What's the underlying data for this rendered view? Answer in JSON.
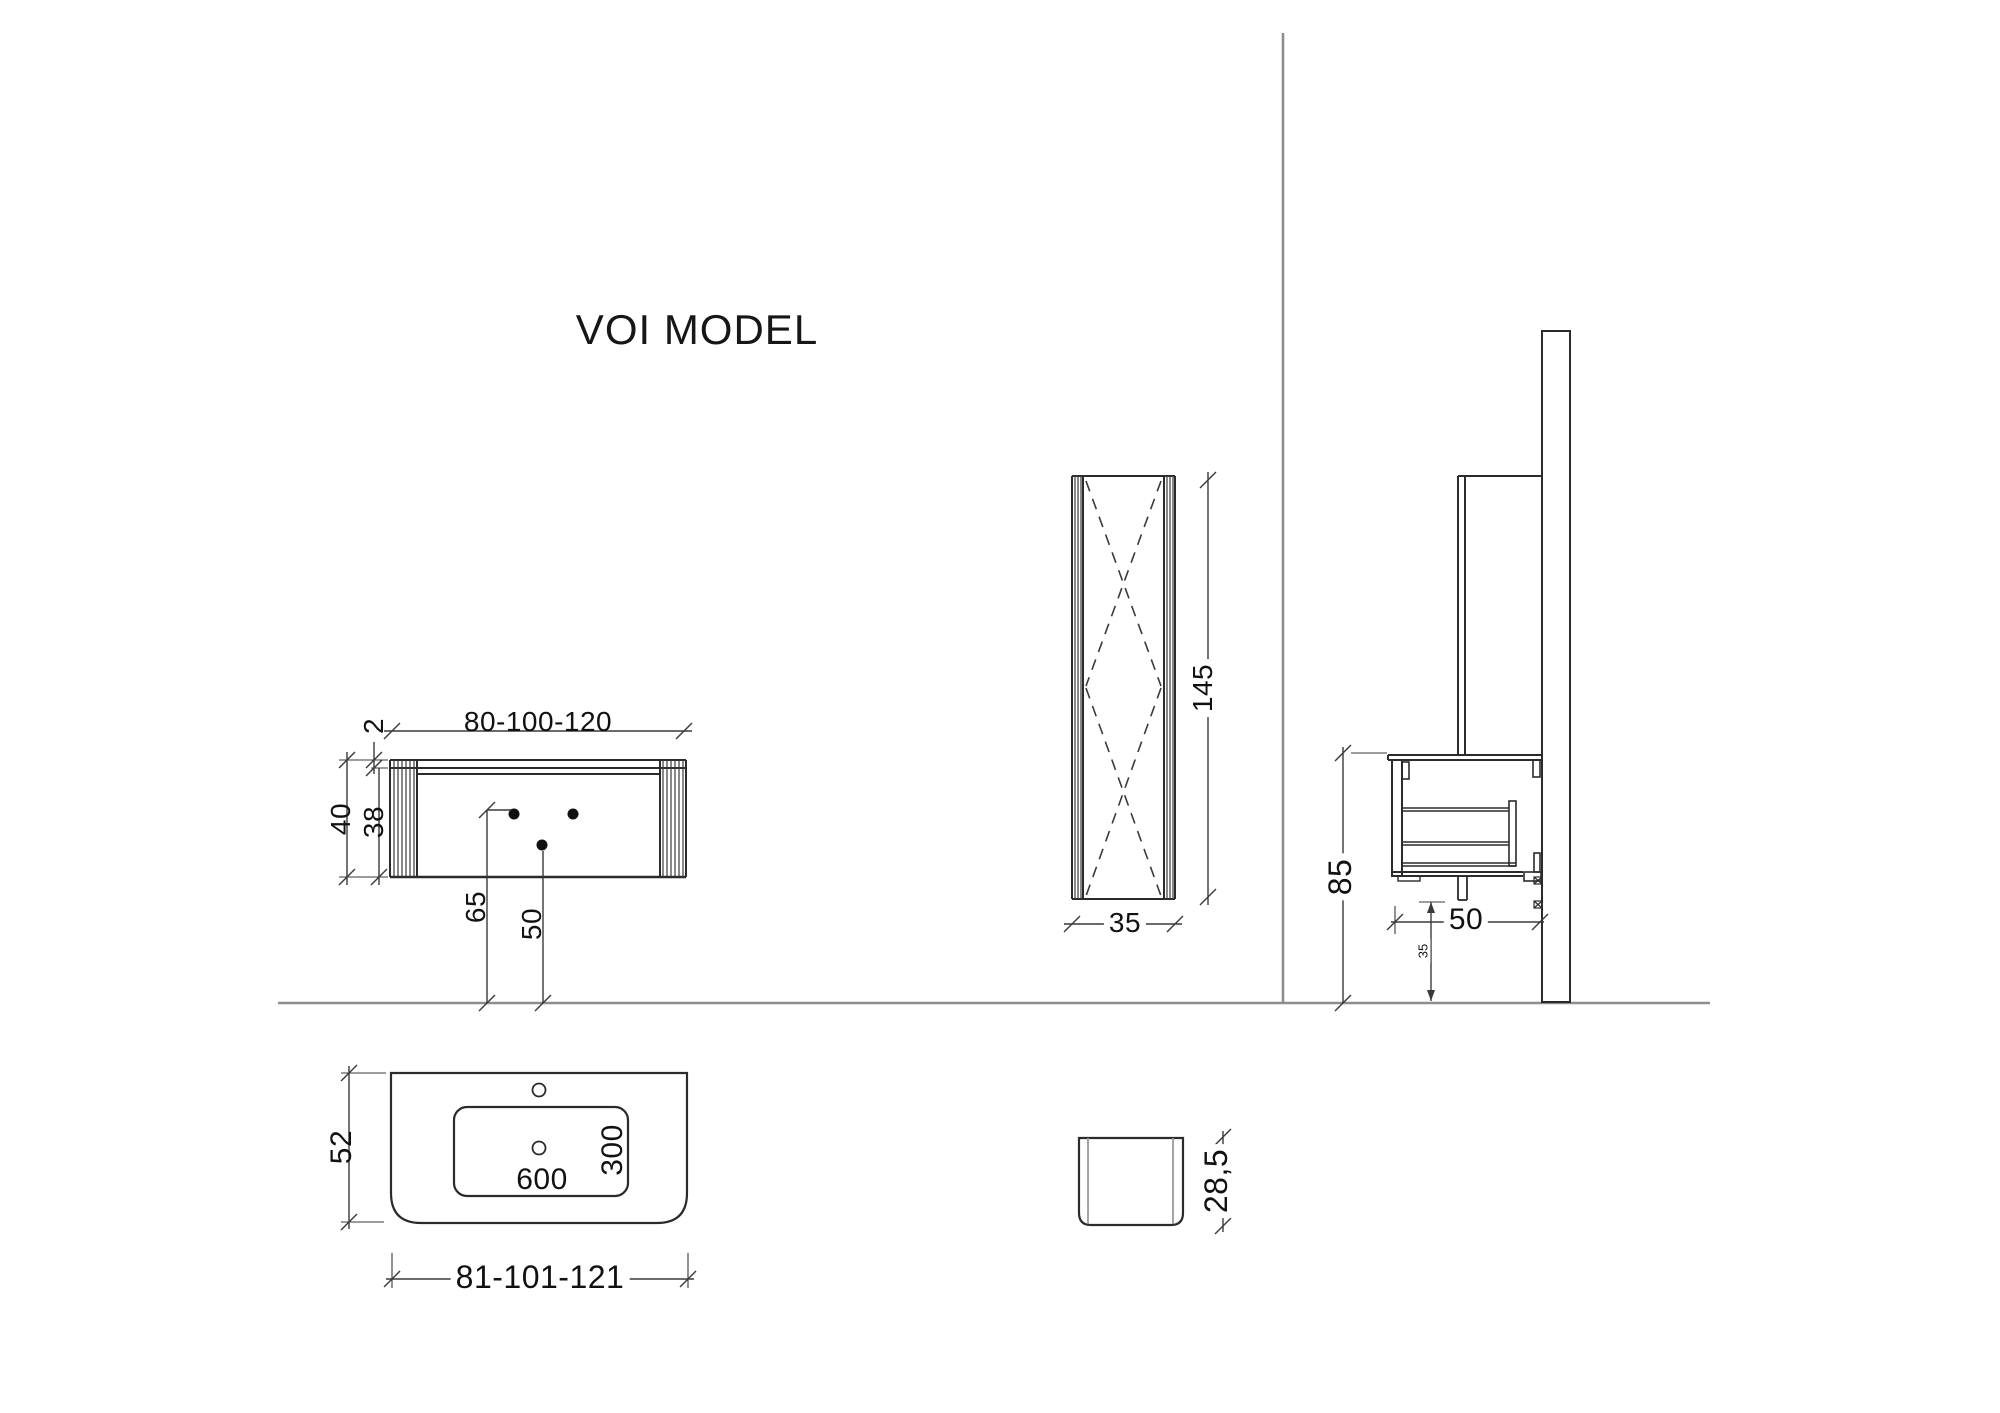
{
  "title": "VOI MODEL",
  "views": {
    "vanity_front": {
      "width": "80-100-120",
      "top_thickness": "2",
      "total_height": "40",
      "body_height": "38",
      "faucet_height": "65",
      "drain_height": "50"
    },
    "column_front": {
      "height": "145",
      "width": "35"
    },
    "side": {
      "mount_height": "85",
      "depth": "50",
      "drain_offset": "35"
    },
    "basin_top": {
      "depth": "52",
      "bowl_width": "600",
      "bowl_depth": "300",
      "width": "81-101-121"
    },
    "basin_side": {
      "height": "28,5"
    }
  },
  "colors": {
    "object_line": "#2b2b2b",
    "dimension_line": "#3a3a3a",
    "wall_floor_line": "#8d8d8d",
    "text": "#111111",
    "background": "#ffffff"
  }
}
